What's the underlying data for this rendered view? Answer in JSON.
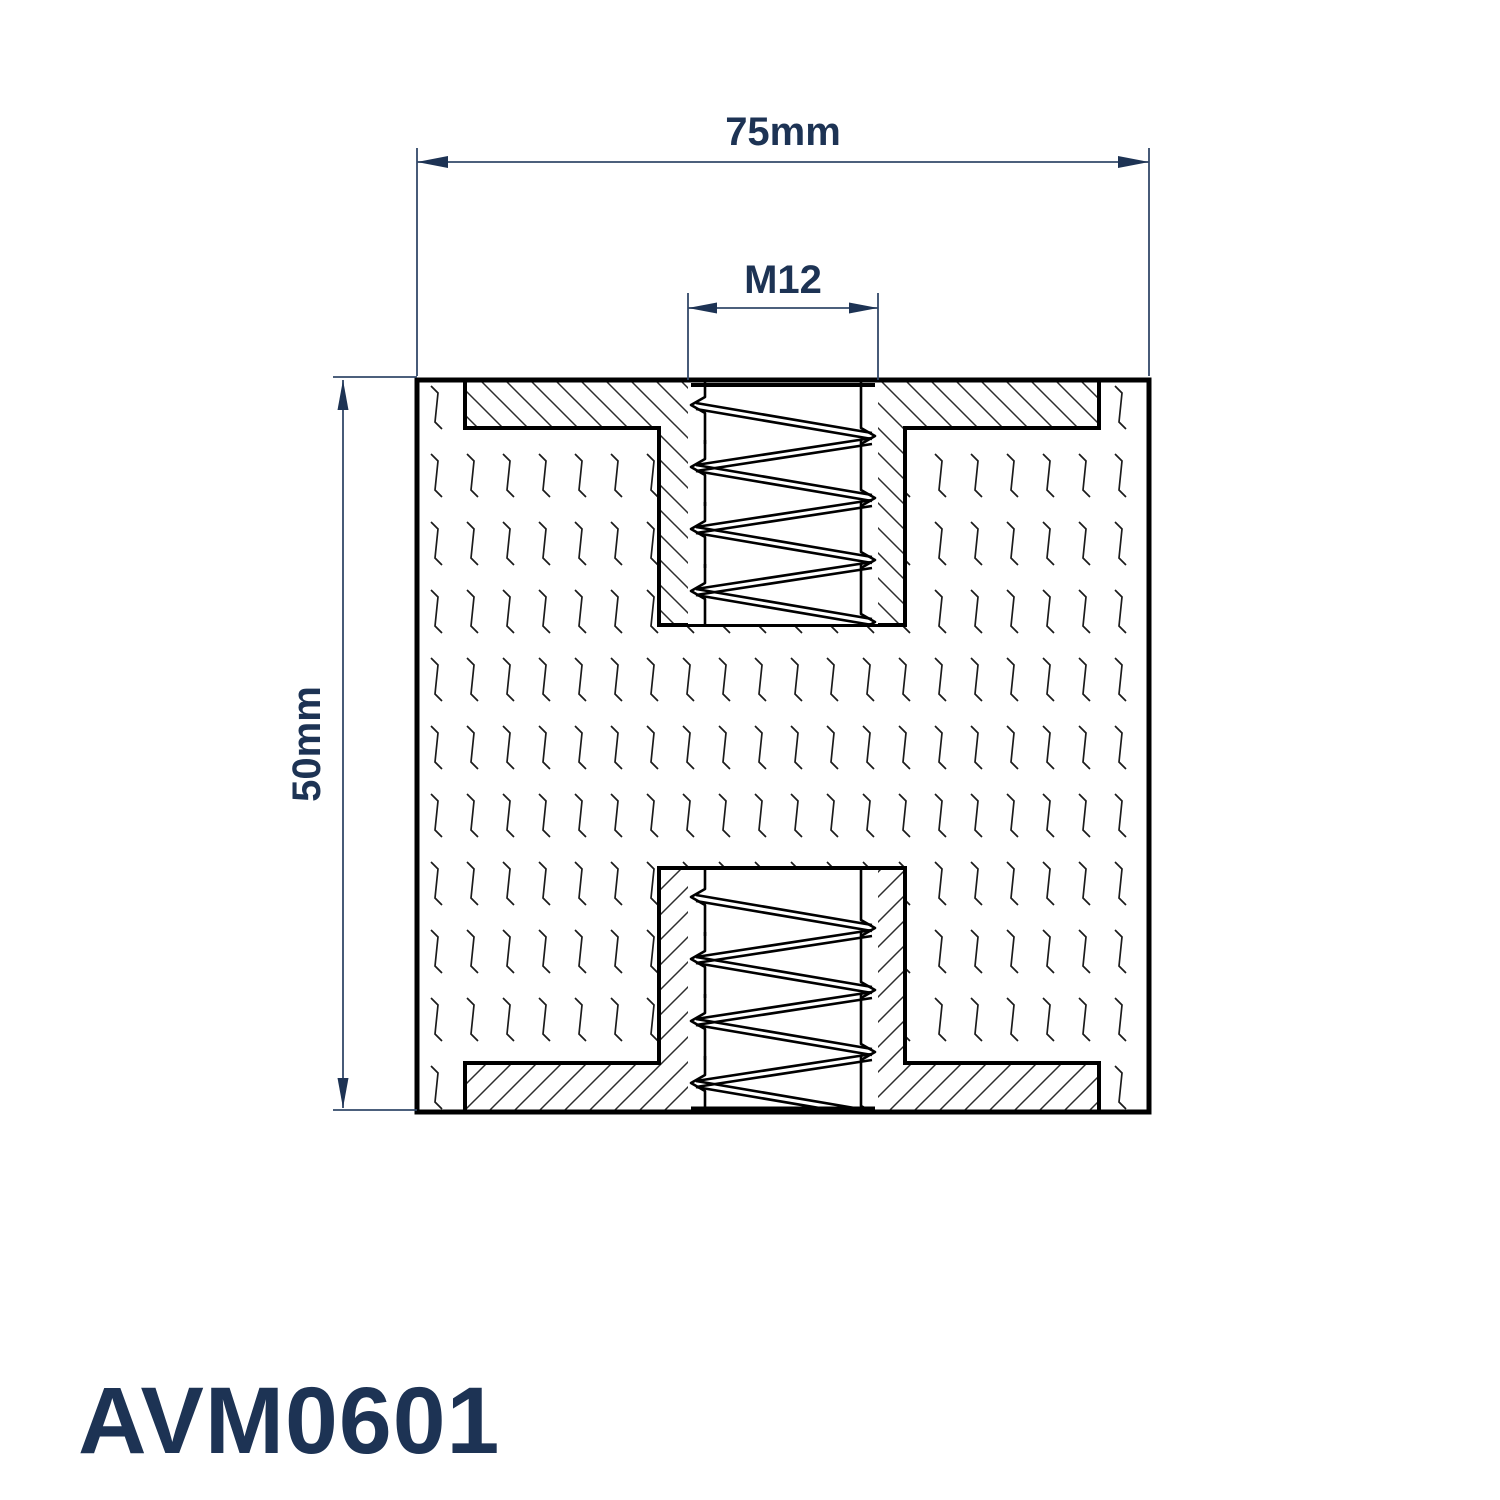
{
  "drawing": {
    "part_number": "AVM0601",
    "dimension_width_label": "75mm",
    "dimension_height_label": "50mm",
    "thread_label": "M12",
    "colors": {
      "annotation_navy": "#1d3354",
      "dimension_line": "#33496a",
      "drawing_line": "#000000",
      "background": "#ffffff"
    }
  }
}
